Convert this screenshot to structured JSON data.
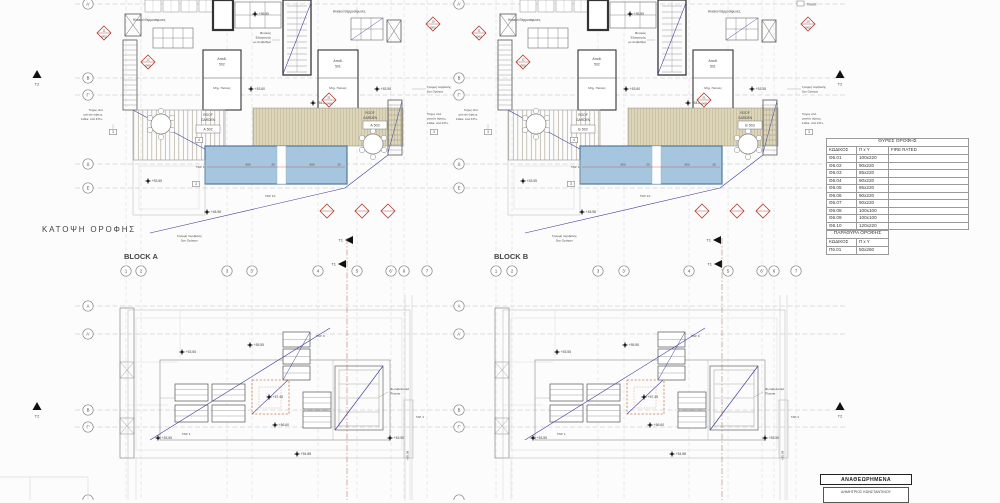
{
  "title": "ΚΑΤΟΨΗ ΟΡΟΦΗΣ",
  "blocks": {
    "a": "BLOCK A",
    "b": "BLOCK B"
  },
  "grid": {
    "rows_top": [
      "Α'",
      "Β",
      "Γ'",
      "Δ",
      "Ε"
    ],
    "rows_bottom": [
      "Α",
      "Α'",
      "Β",
      "Γ'"
    ],
    "cols": [
      "1",
      "2",
      "3",
      "3'",
      "4",
      "5",
      "6'",
      "6",
      "7"
    ]
  },
  "markers": {
    "t1": "T1",
    "t2": "T2"
  },
  "plan": {
    "solar_heaters": "Ηλιακοί Θερμοσίφωνες",
    "vent": [
      "Φυσικός",
      "Εξαερισμός",
      "με Αναβαθμό"
    ],
    "storage": "Αποθ.",
    "storage_501": "501",
    "storage_502": "502",
    "pool_mech": "Μηχ. Πισίνας",
    "roof_garden": [
      "ROOF",
      "GARDEN"
    ],
    "outline_line": [
      "Γραμμή περιβολής",
      "5ου Ορόφου"
    ],
    "wall_note": [
      "Τοίχος από",
      "μπετόν όψεως,",
      "110εκ. από F.P.L."
    ],
    "pv": [
      "Φωτοβολταϊκά",
      "Πλαίσια"
    ],
    "pounti": "Πουντί",
    "keynote_3": "3",
    "keynote_4": "4",
    "tar_1": "ΤΑΡ. 1",
    "tar_3": "ΤΑΡ. 3",
    "tar_9": "ΤΑΡ. 9",
    "tar_10": "ΤΑΡ. 10",
    "dim_500": "500",
    "dim_20": "20"
  },
  "room_tags": {
    "a1": "Α 502",
    "a2": "Α 503",
    "b1": "Β 502",
    "b2": "Β 503"
  },
  "levels": {
    "l4898": "+48.98",
    "l5355": "+53.55",
    "l5360": "+53.60",
    "l5488": "+54.88",
    "l5508": "+55.08",
    "l5555": "+55.55",
    "l5660": "+56.60",
    "l5745": "+57.45"
  },
  "diamonds": {
    "d10": [
      "10",
      "Θ02"
    ],
    "d11": [
      "11",
      "Θ02"
    ],
    "d12": [
      "12",
      "Θ05"
    ],
    "d21": [
      "21",
      "Θ08"
    ]
  },
  "schedules": {
    "doors": {
      "title": "ΘΥΡΕΣ ΟΡΟΦΗΣ",
      "code": "ΚΩΔΙΚΟΣ",
      "size": "Π x Υ",
      "fire": "FIRE RATED",
      "rows": [
        [
          "Θ6.01",
          "100x220"
        ],
        [
          "Θ6.02",
          "90x220"
        ],
        [
          "Θ6.03",
          "85x220"
        ],
        [
          "Θ6.04",
          "90x220"
        ],
        [
          "Θ6.05",
          "85x220"
        ],
        [
          "Θ6.06",
          "90x220"
        ],
        [
          "Θ6.07",
          "90x220"
        ],
        [
          "Θ6.08",
          "100x100"
        ],
        [
          "Θ6.09",
          "100x100"
        ],
        [
          "Θ6.10",
          "120x220"
        ]
      ]
    },
    "windows": {
      "title": "ΠΑΡΑΘΥΡΑ ΟΡΟΦΗΣ",
      "code": "ΚΩΔΙΚΟΣ",
      "size": "Π x Υ",
      "rows": [
        [
          "Π6.01",
          "50x260"
        ]
      ]
    }
  },
  "revision": {
    "title": "ΑΝΑΘΕΩΡΗΜΕΝΑ",
    "name": "ΔΗΜΗΤΡΙΟΣ ΚΩΝΣΤΑΝΤΙΝΟΥ"
  }
}
